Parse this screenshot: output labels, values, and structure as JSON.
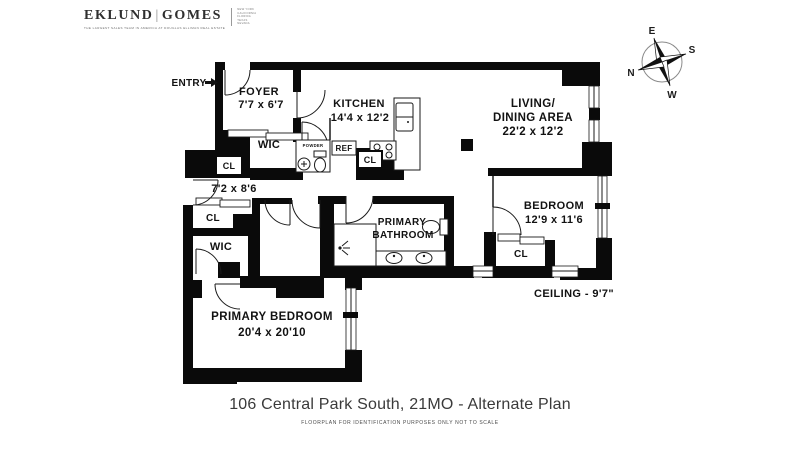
{
  "brand": {
    "name_left": "EKLUND",
    "divider": "|",
    "name_right": "GOMES",
    "tagline": "THE LARGEST SALES TEAM IN AMERICA AT DOUGLAS ELLIMAN REAL ESTATE",
    "regions": [
      "NEW YORK",
      "CALIFORNIA",
      "FLORIDA",
      "TEXAS",
      "NEVADA"
    ]
  },
  "compass": {
    "north": "N",
    "east": "E",
    "south": "S",
    "west": "W"
  },
  "rooms": {
    "entry": {
      "label": "ENTRY"
    },
    "foyer": {
      "name": "FOYER",
      "dims": "7'7 x 6'7"
    },
    "kitchen": {
      "name": "KITCHEN",
      "dims": "14'4 x 12'2"
    },
    "living": {
      "name1": "LIVING/",
      "name2": "DINING AREA",
      "dims": "22'2 x 12'2"
    },
    "bedroom": {
      "name": "BEDROOM",
      "dims": "12'9 x 11'6"
    },
    "primary_bathroom": {
      "name1": "PRIMARY",
      "name2": "BATHROOM"
    },
    "primary_bedroom": {
      "name": "PRIMARY BEDROOM",
      "dims": "20'4 x 20'10"
    },
    "hallway": {
      "dims": "7'2 x 8'6"
    },
    "wic_upper": "WIC",
    "wic_lower": "WIC",
    "powder": "POWDER",
    "ref": "REF",
    "cl_foyer": "CL",
    "cl_kitchen": "CL",
    "cl_hall": "CL",
    "cl_bedroom": "CL",
    "ceiling": "CEILING - 9'7\""
  },
  "footer": {
    "title": "106 Central Park South, 21MO - Alternate Plan",
    "disclaimer": "FLOORPLAN FOR IDENTIFICATION PURPOSES ONLY NOT TO SCALE"
  }
}
